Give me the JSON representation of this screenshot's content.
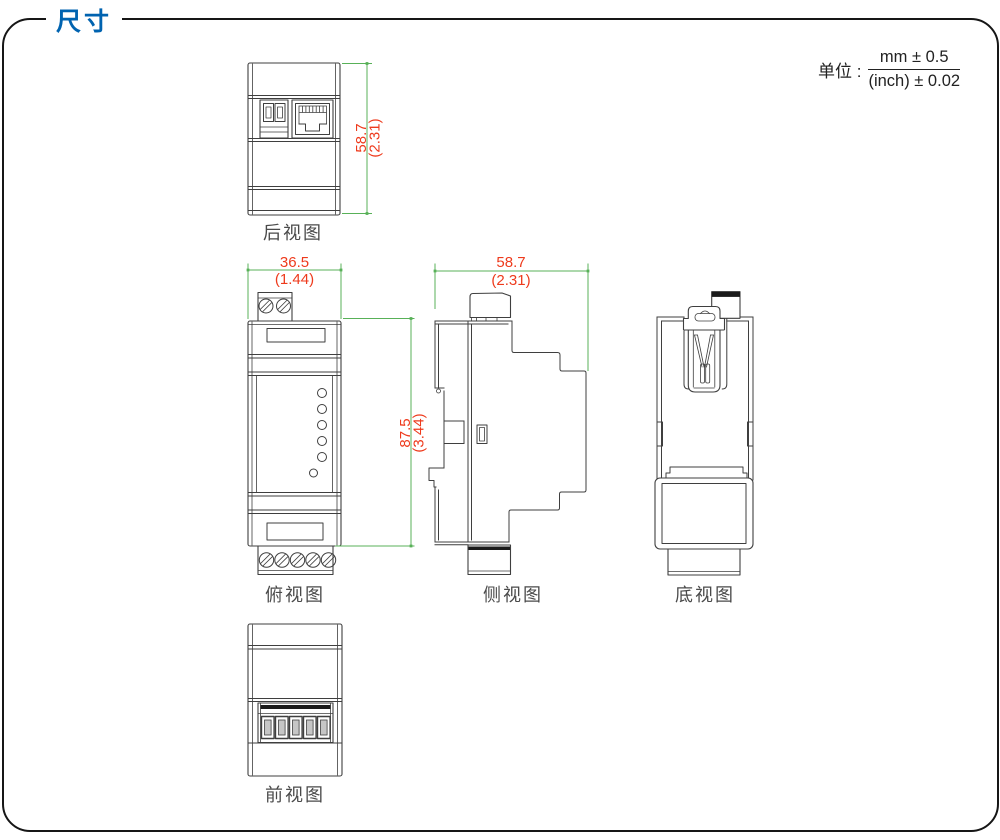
{
  "page": {
    "section_title": "尺寸"
  },
  "units": {
    "label": "单位 :",
    "mm_tolerance": "mm ± 0.5",
    "inch_tolerance": "(inch) ± 0.02"
  },
  "views": {
    "rear": {
      "label": "后视图",
      "height_mm": "58.7",
      "height_inch": "(2.31)"
    },
    "top": {
      "label": "俯视图",
      "width_mm": "36.5",
      "width_inch": "(1.44)",
      "height_mm": "87.5",
      "height_inch": "(3.44)"
    },
    "side": {
      "label": "侧视图",
      "width_mm": "58.7",
      "width_inch": "(2.31)"
    },
    "bottom": {
      "label": "底视图"
    },
    "front": {
      "label": "前视图"
    }
  },
  "colors": {
    "accent_blue": "#0063b0",
    "dimension_text_red": "#ee3a1c",
    "dimension_line_green": "#58b158",
    "drawing_line": "#3f3f3f"
  }
}
